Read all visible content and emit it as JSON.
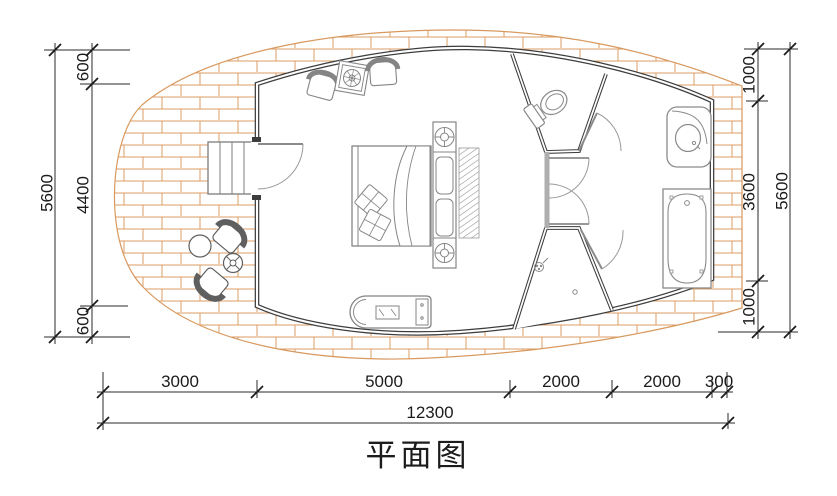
{
  "title": "平面图",
  "dims": {
    "left_total": "5600",
    "left": [
      "600",
      "4400",
      "600"
    ],
    "right": [
      "1000",
      "3600",
      "1000"
    ],
    "right_total": "5600",
    "bottom": [
      "3000",
      "5000",
      "2000",
      "2000",
      "300"
    ],
    "bottom_total": "12300"
  },
  "colors": {
    "deck_brick": "#dd9e64",
    "wall": "#3d3d3d",
    "furniture": "#858585",
    "dimension": "#1c1c1c"
  },
  "fixtures": [
    "wood-deck",
    "entry-stairs",
    "entry-door",
    "armchair",
    "side-table-plant",
    "double-bed",
    "pillows",
    "bedside-lamp-column",
    "louver-wardrobe",
    "tv-cabinet",
    "toilet",
    "washbasin",
    "bathtub",
    "shower-room",
    "deck-chair",
    "deck-round-table",
    "deck-small-table"
  ]
}
